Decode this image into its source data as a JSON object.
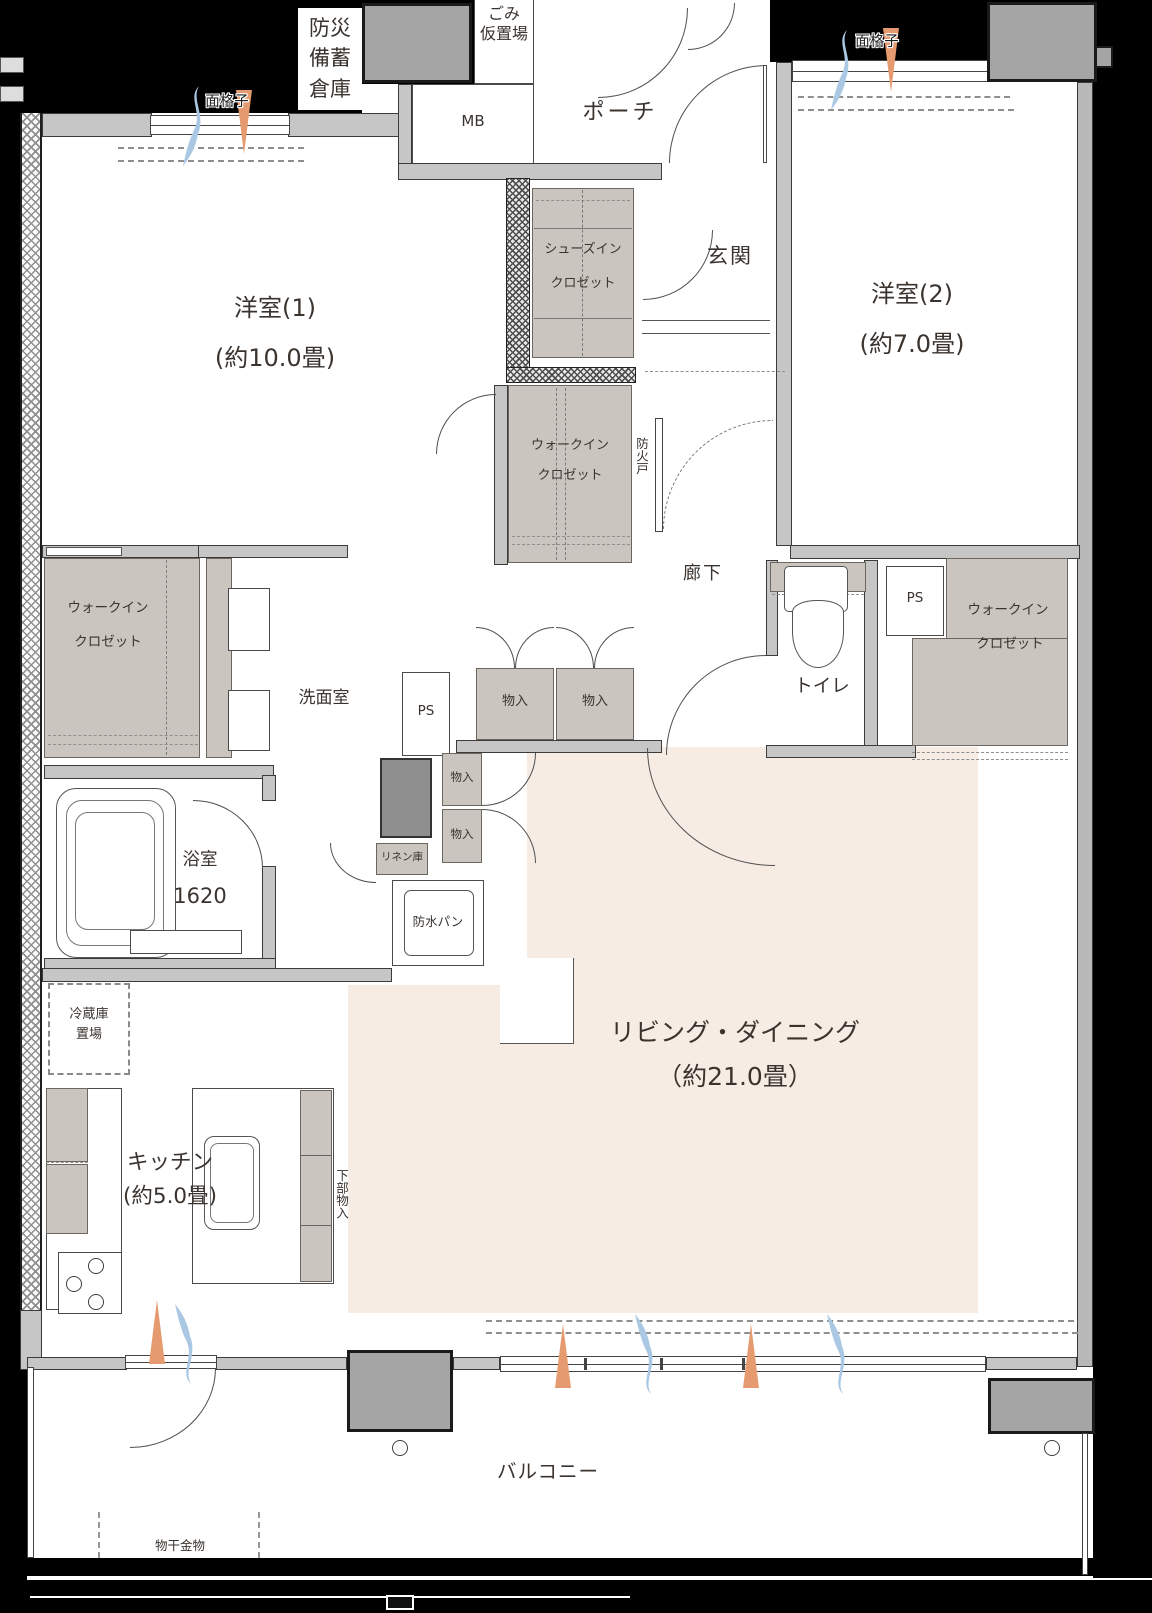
{
  "rooms": {
    "western1": {
      "name": "洋室(1)",
      "size": "(約10.0畳)"
    },
    "western2": {
      "name": "洋室(2)",
      "size": "(約7.0畳)"
    },
    "living": {
      "name": "リビング・ダイニング",
      "size": "（約21.0畳）"
    },
    "kitchen": {
      "name": "キッチン",
      "size": "(約5.0畳)"
    },
    "bath": {
      "name": "浴室",
      "size": "1620"
    },
    "washroom": {
      "name": "洗面室"
    },
    "toilet": {
      "name": "トイレ"
    },
    "entrance": {
      "name": "玄関"
    },
    "hallway": {
      "name": "廊下"
    },
    "porch": {
      "name": "ポーチ"
    },
    "balcony": {
      "name": "バルコニー"
    }
  },
  "storage": {
    "shoes_closet_line1": "シューズイン",
    "shoes_closet_line2": "クロゼット",
    "walkin_line1": "ウォークイン",
    "walkin_line2": "クロゼット",
    "storage_label": "物入",
    "linen": "リネン庫",
    "under_counter": "下部物入"
  },
  "fixtures": {
    "mb": "MB",
    "ps": "PS",
    "fire_door": "防火戸",
    "waterproof_pan": "防水パン",
    "fridge_line1": "冷蔵庫",
    "fridge_line2": "置場",
    "disaster_line1": "防災",
    "disaster_line2": "備蓄",
    "disaster_line3": "倉庫",
    "trash_line1": "ごみ",
    "trash_line2": "仮置場",
    "laundry_hardware": "物干金物",
    "window_grille": "面格子"
  },
  "colors": {
    "ld_fill": "#f7ece4",
    "closet_fill": "#cac6bf",
    "wall_fill": "#c6c6c6",
    "pillar_fill": "#a5a5a5",
    "arrow_in_orange": "#e59a6f",
    "arrow_out_blue": "#aac8e3"
  }
}
